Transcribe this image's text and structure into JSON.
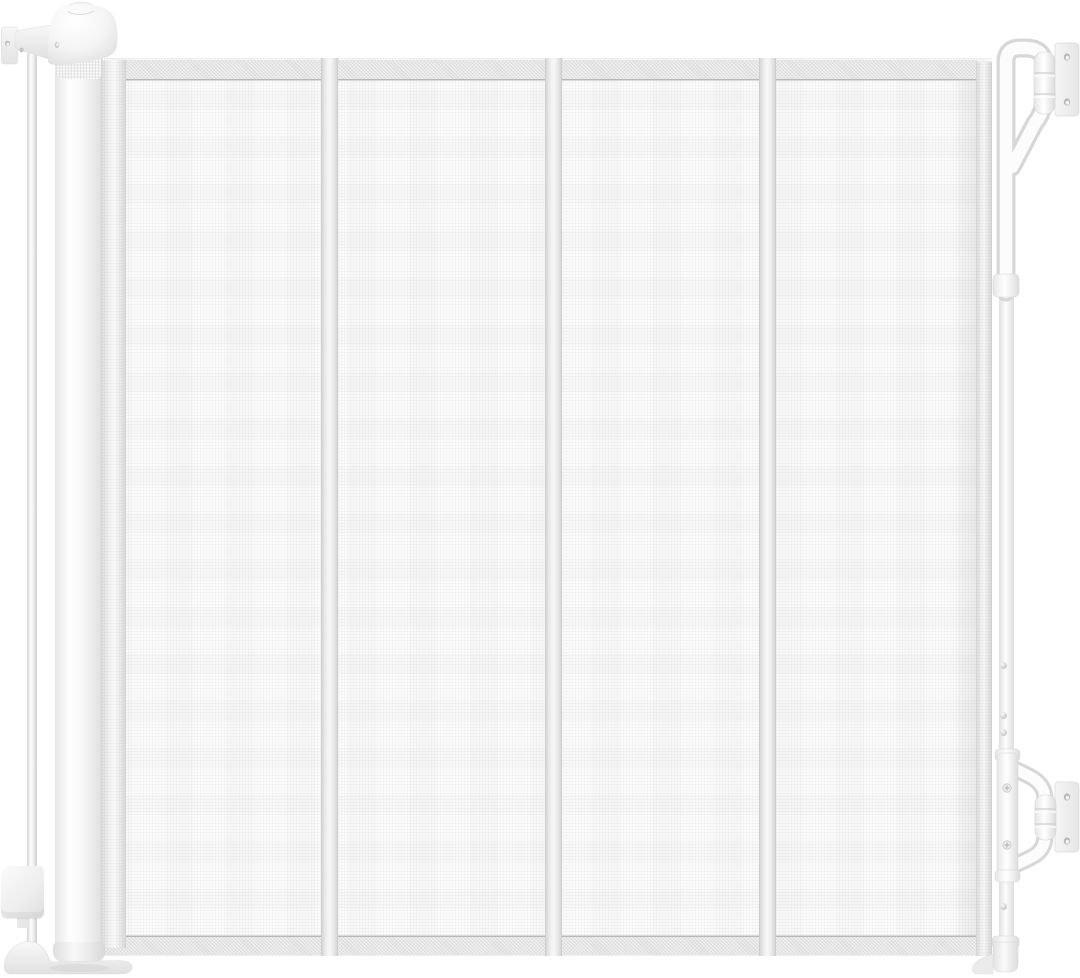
{
  "scene": {
    "type": "product-photo",
    "subject": "White retractable mesh safety gate: roll-up post on the left, four mesh sections with vertical seams, wall-mount latch brackets and catch bar on the right",
    "background": "#ffffff"
  },
  "colors": {
    "white": "#ffffff",
    "mesh": "#fcfcfc",
    "band": "#e3e3e3",
    "hairline": "#b8b8b8",
    "seam-edge": "#d8d8d8",
    "seam-center": "#f8f8f8",
    "tube-shade": "#d7d7d7",
    "tube-light": "#fcfcfc",
    "plate": "#f2f2f2",
    "hole": "#b8b8b8"
  },
  "mesh": {
    "sections": 4,
    "seam_x": [
      328,
      552,
      766
    ],
    "panel": {
      "left": 104,
      "top": 58,
      "width": 888,
      "height": 898
    },
    "top_band_y": [
      60,
      81
    ],
    "bottom_band_y": [
      937,
      955
    ]
  },
  "left_assembly": {
    "parts": [
      "top-cap",
      "cap-top-button",
      "wall-bracket",
      "tension-rod",
      "roller-post",
      "knurled-ring",
      "rolled-mesh-edge",
      "lock-latch",
      "base-foot"
    ],
    "wall_bracket_holes": 2
  },
  "right_assembly": {
    "parts": [
      "top-latch-bracket",
      "top-wall-plate",
      "catch-bar",
      "bottom-latch-bracket",
      "bottom-wall-plate",
      "bar-foot"
    ],
    "bar_screws_y": [
      665,
      715,
      732,
      906
    ],
    "sleeve_screws_y": [
      788,
      845
    ],
    "top_wall_plate_holes": 2,
    "bottom_wall_plate_holes": 2
  }
}
